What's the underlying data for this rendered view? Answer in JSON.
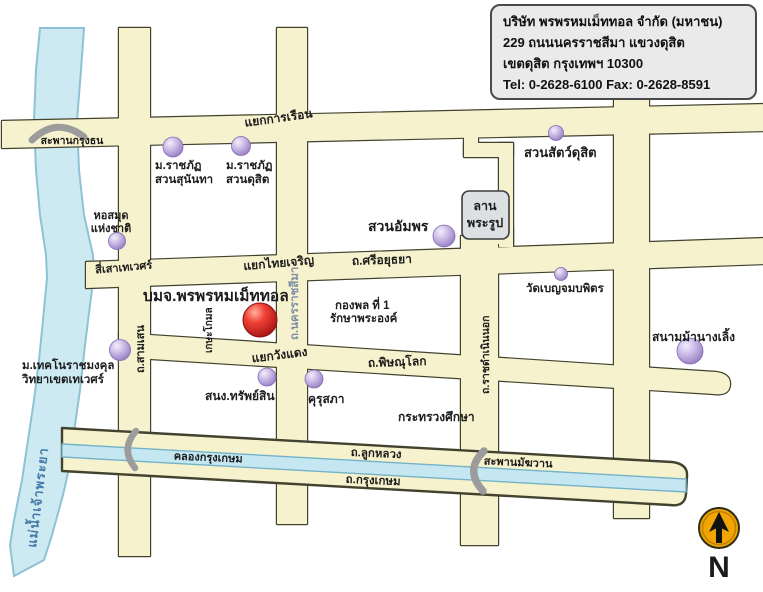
{
  "title_card": {
    "line1": "บริษัท พรพรหมเม็ททอล จำกัด (มหาชน)",
    "line2": "229 ถนนนครราชสีมา  แขวงดุสิต",
    "line3": "เขตดุสิต กรุงเทพฯ 10300",
    "line4": "Tel: 0-2628-6100   Fax: 0-2628-8591"
  },
  "company": {
    "name": "บมจ.พรพรหมเม็ททอล",
    "marker_color": "#e02b20"
  },
  "river": {
    "name": "แม่น้ำเจ้าพระยา",
    "color": "#cdeaf2"
  },
  "canal": {
    "name": "คลองกรุงเกษม",
    "color": "#c5e7f2"
  },
  "bridges": {
    "krung_thon": "สะพานกรุงธน",
    "makkhawan": "สะพานมัฆวาน"
  },
  "intersections": {
    "kan_ruean": "แยกการเรือน",
    "si_sao_thewet": "สี่เสาเทเวศร์",
    "thai_charoen": "แยกไทยเจริญ",
    "wang_daeng": "แยกวังแดง"
  },
  "roads": {
    "si_ayutthaya": "ถ.ศรีอยุธยา",
    "nakhon_ratchasima": "ถ.นครราชสีมา",
    "samsen": "ถ.สามเสน",
    "kasa_komon": "เกษะโกมล",
    "phitsanulok": "ถ.พิษณุโลก",
    "ratchadamnoen_nok": "ถ.ราชดำเนินนอก",
    "luk_luang": "ถ.ลูกหลวง",
    "krung_kasem": "ถ.กรุงเกษม",
    "road_color": "#f6f2cd"
  },
  "places": {
    "rajabhat_sunandha": {
      "line1": "ม.ราชภัฏ",
      "line2": "สวนสุนันทา"
    },
    "rajabhat_dusit": {
      "line1": "ม.ราชภัฏ",
      "line2": "สวนดุสิต"
    },
    "dusit_zoo": {
      "name": "สวนสัตว์ดุสิต"
    },
    "national_library": {
      "line1": "หอสมุด",
      "line2": "แห่งชาติ"
    },
    "royal_plaza": {
      "line1": "ลาน",
      "line2": "พระรูป"
    },
    "amphorn_garden": {
      "name": "สวนอัมพร"
    },
    "first_division": {
      "line1": "กองพล ที่ 1",
      "line2": "รักษาพระองค์"
    },
    "wat_benchamabophit": {
      "name": "วัดเบญจมบพิตร"
    },
    "rajamangala": {
      "line1": "ม.เทคโนราชมงคุล",
      "line2": "วิทยาเขตเทเวศร์"
    },
    "crown_property": {
      "name": "สนง.ทรัพย์สิน"
    },
    "khurusapha": {
      "name": "คุรุสภา"
    },
    "ministry_education": {
      "name": "กระทรวงศึกษา"
    },
    "nang_loeng_racecourse": {
      "name": "สนามม้านางเลิ้ง"
    },
    "marker_color": "#a98fd0"
  },
  "compass": {
    "label": "N",
    "color": "#f0a500"
  }
}
